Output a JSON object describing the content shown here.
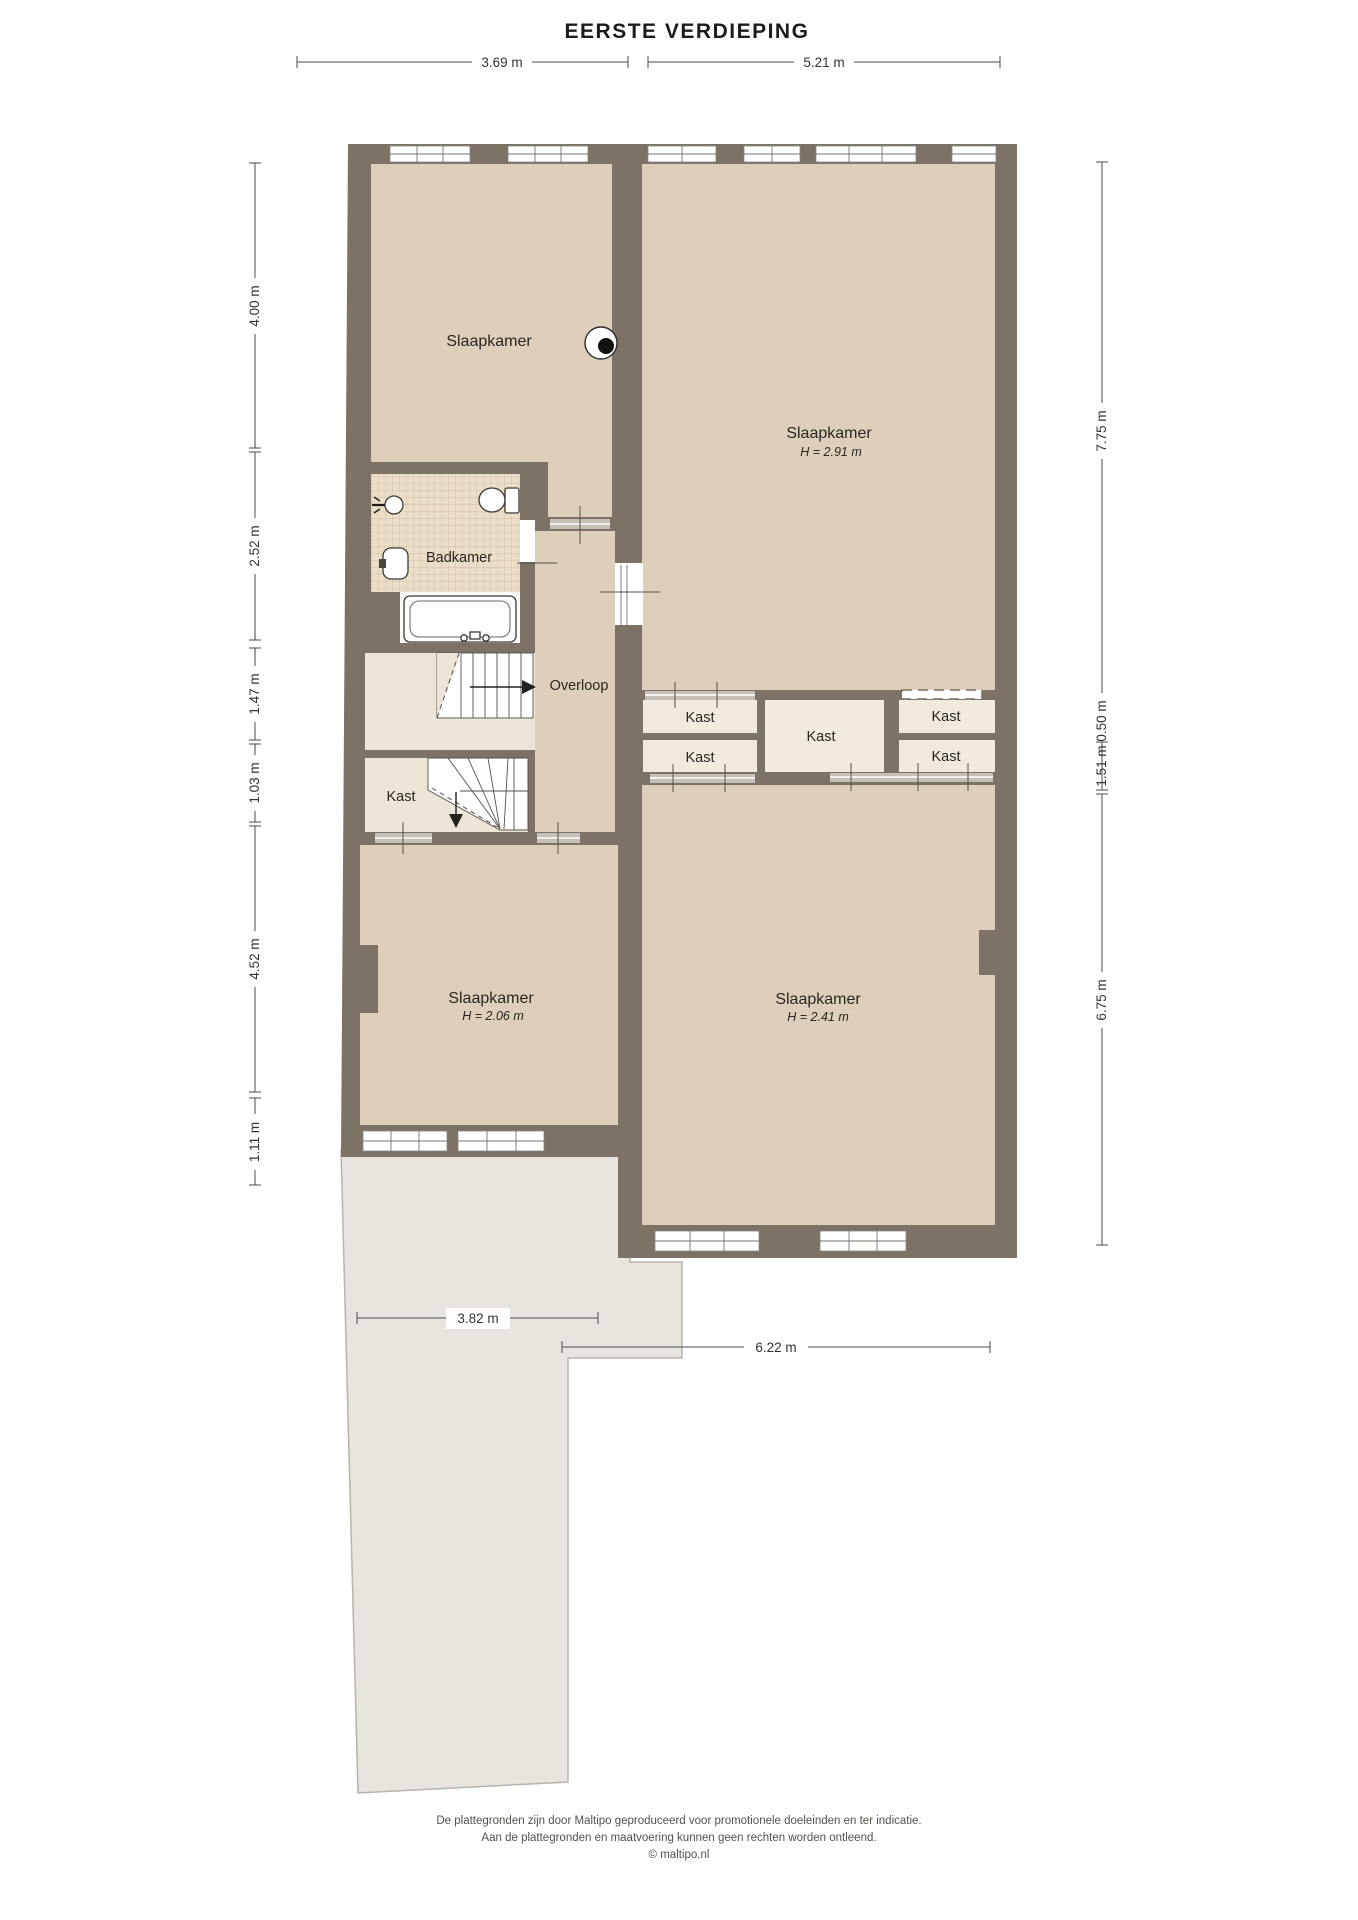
{
  "title": "EERSTE VERDIEPING",
  "rooms": {
    "bedroom_tl": {
      "label": "Slaapkamer"
    },
    "bedroom_tr": {
      "label": "Slaapkamer",
      "height": "H = 2.91 m"
    },
    "bathroom": {
      "label": "Badkamer"
    },
    "landing": {
      "label": "Overloop"
    },
    "closet_stairs": {
      "label": "Kast"
    },
    "closet_a": {
      "label": "Kast"
    },
    "closet_b": {
      "label": "Kast"
    },
    "closet_c": {
      "label": "Kast"
    },
    "closet_d": {
      "label": "Kast"
    },
    "closet_e": {
      "label": "Kast"
    },
    "bedroom_bl": {
      "label": "Slaapkamer",
      "height": "H = 2.06 m"
    },
    "bedroom_br": {
      "label": "Slaapkamer",
      "height": "H = 2.41 m"
    }
  },
  "dimensions": {
    "top": [
      "3.69 m",
      "5.21 m"
    ],
    "left": [
      "4.00 m",
      "2.52 m",
      "1.47 m",
      "1.03 m",
      "4.52 m",
      "1.11 m"
    ],
    "right": [
      "7.75 m",
      "0.50 m",
      "1.51 m",
      "6.75 m"
    ],
    "bottom": [
      "3.82 m",
      "6.22 m"
    ]
  },
  "footer": {
    "line1": "De plattegronden zijn door Maltipo geproduceerd voor promotionele doeleinden en ter indicatie.",
    "line2": "Aan de plattegronden en maatvoering kunnen geen rechten worden ontleend.",
    "line3": "© maltipo.nl"
  },
  "colors": {
    "wall": "#7c7266",
    "floor": "#decfba",
    "floor_light": "#ece5d8",
    "closet_floor": "#f1eadd",
    "tile_base": "#ecdfc9",
    "tile_grid": "#c9b69a",
    "roof": "#e8e5de",
    "door_track": "#c6c1b8"
  }
}
